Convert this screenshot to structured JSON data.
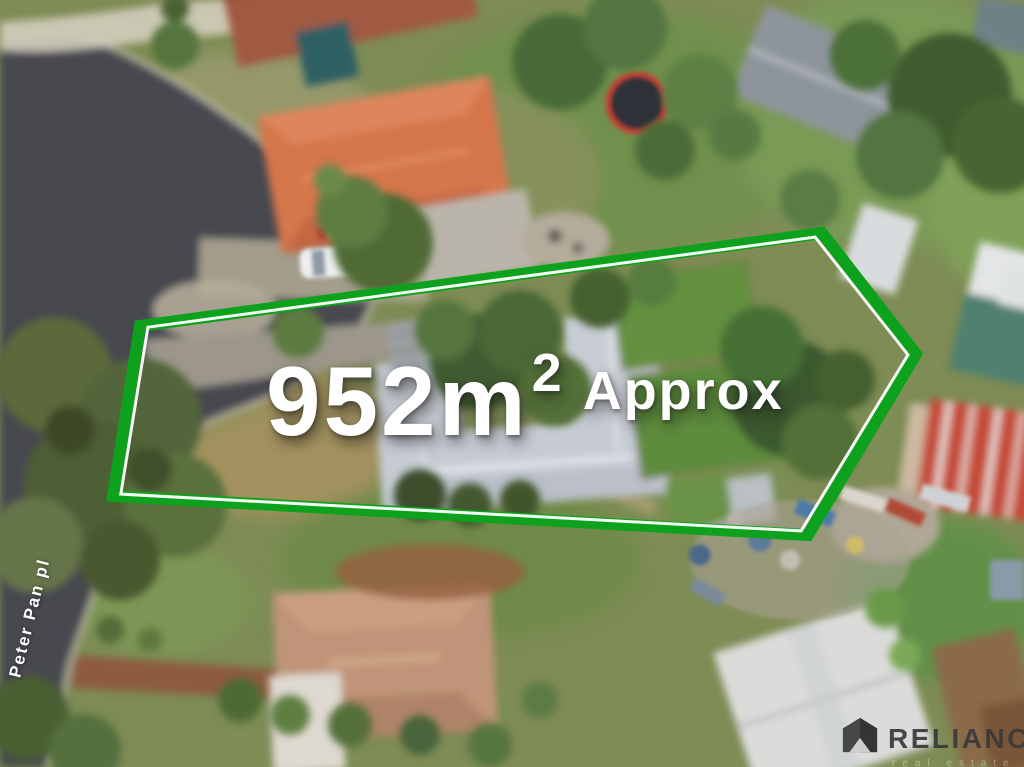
{
  "annotations": {
    "boundary_color": "#0ea11d",
    "boundary_inner_line_color": "#ffffff",
    "area": {
      "value": "952m",
      "superscript": "2",
      "qualifier": "Approx",
      "text_color": "#ffffff"
    },
    "street": {
      "name": "Peter Pan pl",
      "text_color": "#ffffff"
    }
  },
  "watermark": {
    "brand": "RELIANCE",
    "tagline": "real estate",
    "icon": "reliance-house-icon",
    "brand_color": "#3a3a3c"
  },
  "scene": {
    "type": "aerial-drone-photograph",
    "description": "Bird's-eye drone photo of a suburban street: a long residential lot outlined in green with its land area printed across the middle; dark asphalt cul-de-sac named Peter Pan pl on the left; neighbouring houses with orange, grey, red and tan roofs; lawns, dense trees, sheds, a trampoline, and a cluttered yard with boats and a white marquee bottom-right."
  }
}
